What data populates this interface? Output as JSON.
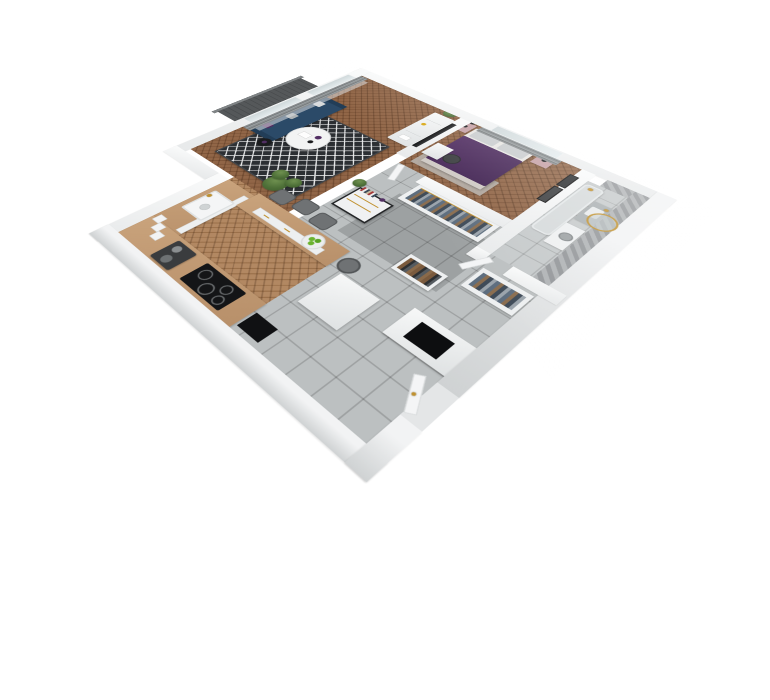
{
  "title": "3D isometric apartment floor plan render",
  "theme": {
    "bg": "#ffffff",
    "wall": "#f2f3f4",
    "wallEdge": "#d7d9da",
    "wallDark": "#c9cccd",
    "wood": "#8a5c3c",
    "woodDark": "#6f4628",
    "woodK": "#a97a50",
    "counter": "#c9a37c",
    "cab": "#edeff0",
    "tile": "#bcc0c1",
    "bathTile": "#c6cacb",
    "herring": "#94979a",
    "herringLight": "#b0b3b5",
    "balcony": "#55585a",
    "rail": "#808486",
    "rug": "#2c2f33",
    "rugLine": "#e8e9ea",
    "bedRug": "#b5afa8",
    "sofa": "#2b4a68",
    "sofaDark": "#223d57",
    "cushion": "#d8dadb",
    "purple": "#512e62",
    "purpleDeep": "#3f2150",
    "pink": "#c5a0a5",
    "curtain": "#8a8e90",
    "sheer": "#dcdfe0",
    "glass": "#cfd8da",
    "gold": "#c0912f",
    "black": "#1a1b1d",
    "dark": "#2e3032",
    "plant": "#4e7038",
    "plantDark": "#3c5a2b",
    "apple": "#6ab32e",
    "gray": "#6f7274",
    "white": "#f6f7f8",
    "tub": "#d6dadb",
    "fixture": "#aab0b2",
    "clothes1": "#5d6d7e",
    "clothes2": "#8a6d4f",
    "clothes3": "#3e4a57",
    "clothes4": "#9aa3ab"
  },
  "rooms": {
    "living": {
      "label": "Living room with navy sofa, TV sideboard and patterned rug",
      "floor": "herringbone wood"
    },
    "bedroom": {
      "label": "Bedroom with purple double bed and pink nightstands",
      "floor": "herringbone wood"
    },
    "bathroom": {
      "label": "Bathroom with herringbone tiled walls, tub, vanity and round gold mirror",
      "floor": "gray tile"
    },
    "hallway": {
      "label": "Hallway with open wardrobes, shoe rack and console table",
      "floor": "gray tile"
    },
    "kitchen": {
      "label": "Kitchen with wooden counters, breakfast bar, sink and cooktop",
      "floor": "herringbone wood"
    },
    "balcony": {
      "label": "Balcony",
      "floor": "dark decking"
    }
  },
  "furniture": {
    "living": [
      "gray curtains",
      "sheer curtain",
      "radiator",
      "navy sofa",
      "white pillow",
      "gray pillow",
      "purple pillow",
      "round coffee table",
      "black side table",
      "diamond rug",
      "TV sideboard",
      "flat screen TV",
      "potted plant",
      "tall plant"
    ],
    "bedroom": [
      "double bed with purple duvet",
      "gray pillows",
      "pink nightstand left",
      "pink nightstand right",
      "black floor lamp",
      "wall art frames",
      "desk",
      "office chair",
      "bedside rug"
    ],
    "bathroom": [
      "bathtub",
      "gold shower fixture",
      "vanity with sink",
      "gold faucet",
      "round gold mirror",
      "washing machine",
      "door"
    ],
    "hallway": [
      "open wardrobe with clothes",
      "second clothes rack",
      "shoe rack",
      "console table with books",
      "plant",
      "utility niche",
      "entry door"
    ],
    "kitchen": [
      "west counter with sink",
      "gold faucet",
      "south counter",
      "induction cooktop",
      "coffee machine",
      "storage jars",
      "breakfast bar",
      "bar drawers",
      "dining chairs",
      "bar stool",
      "fruit bowl with green apples",
      "white appliance",
      "black floor mat"
    ]
  }
}
